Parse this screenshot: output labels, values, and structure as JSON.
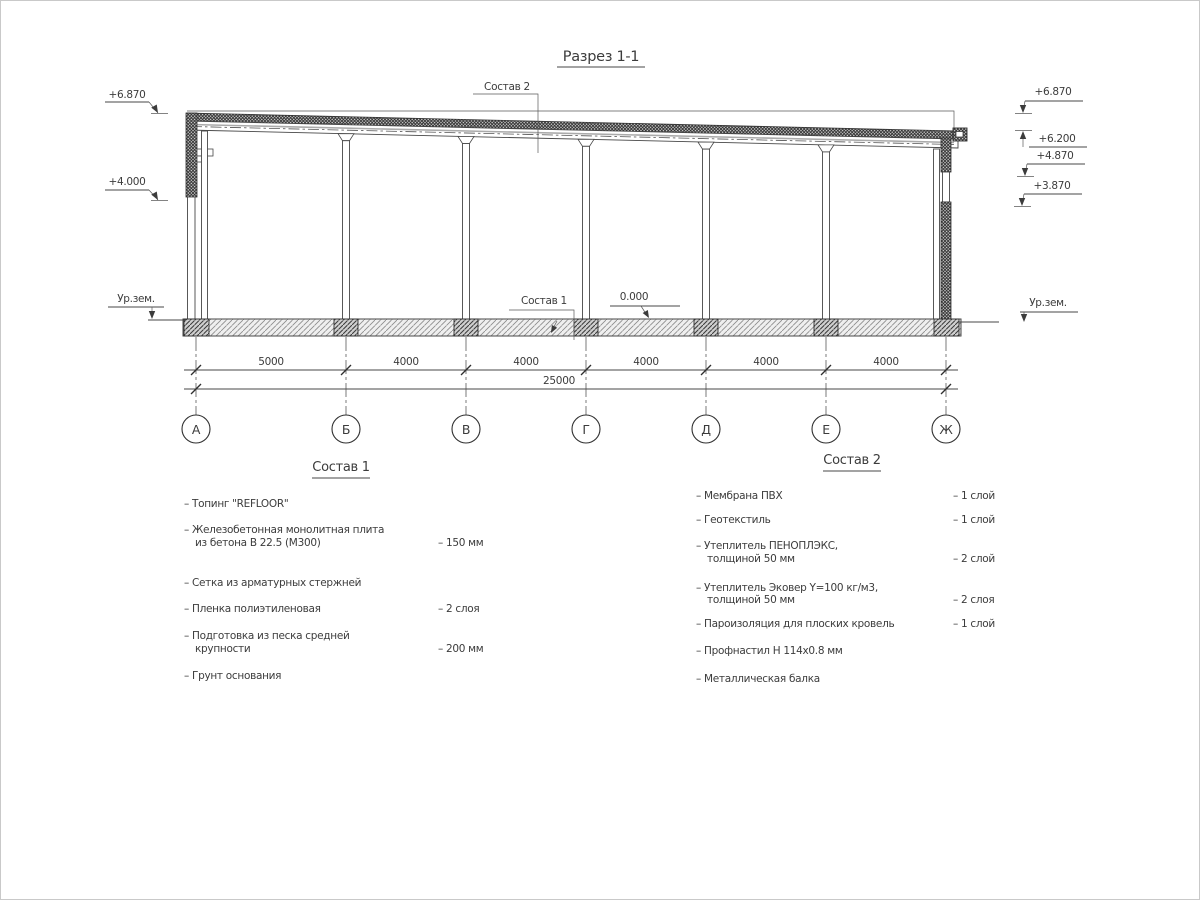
{
  "title": "Разрез 1-1",
  "labels": {
    "sostav2_callout": "Состав 2",
    "sostav1_callout": "Состав 1",
    "zero_level": "0.000",
    "ground_left": "Ур.зем.",
    "ground_right": "Ур.зем."
  },
  "elevations": {
    "left": [
      "+6.870",
      "+4.000"
    ],
    "right": [
      "+6.870",
      "+6.200",
      "+4.870",
      "+3.870"
    ]
  },
  "dimensions": {
    "segments": [
      "5000",
      "4000",
      "4000",
      "4000",
      "4000",
      "4000"
    ],
    "total": "25000"
  },
  "axes": [
    "А",
    "Б",
    "В",
    "Г",
    "Д",
    "Е",
    "Ж"
  ],
  "comp1": {
    "heading": "Состав 1",
    "items": [
      {
        "line1": "– Топинг \"REFLOOR\"",
        "line2": "",
        "value": ""
      },
      {
        "line1": "– Железобетонная  монолитная плита",
        "line2": "из бетона В 22.5 (М300)",
        "value": "– 150 мм"
      },
      {
        "line1": "– Сетка из арматурных стержней",
        "line2": "",
        "value": ""
      },
      {
        "line1": "– Пленка полиэтиленовая",
        "line2": "",
        "value": "– 2 слоя"
      },
      {
        "line1": "– Подготовка из песка средней",
        "line2": "крупности",
        "value": "– 200 мм"
      },
      {
        "line1": "– Грунт основания",
        "line2": "",
        "value": ""
      }
    ]
  },
  "comp2": {
    "heading": "Состав 2",
    "items": [
      {
        "line1": "– Мембрана ПВХ",
        "line2": "",
        "value": "– 1 слой"
      },
      {
        "line1": "– Геотекстиль",
        "line2": "",
        "value": "– 1 слой"
      },
      {
        "line1": "– Утеплитель ПЕНОПЛЭКС,",
        "line2": "толщиной 50 мм",
        "value": "– 2 слой"
      },
      {
        "line1": "– Утеплитель Эковер Y=100 кг/м3,",
        "line2": "толщиной 50 мм",
        "value": "– 2 слоя"
      },
      {
        "line1": "– Пароизоляция для плоских кровель",
        "line2": "",
        "value": "– 1 слой"
      },
      {
        "line1": "– Профнастил Н 114х0.8 мм",
        "line2": "",
        "value": ""
      },
      {
        "line1": "– Металлическая балка",
        "line2": "",
        "value": ""
      }
    ]
  }
}
